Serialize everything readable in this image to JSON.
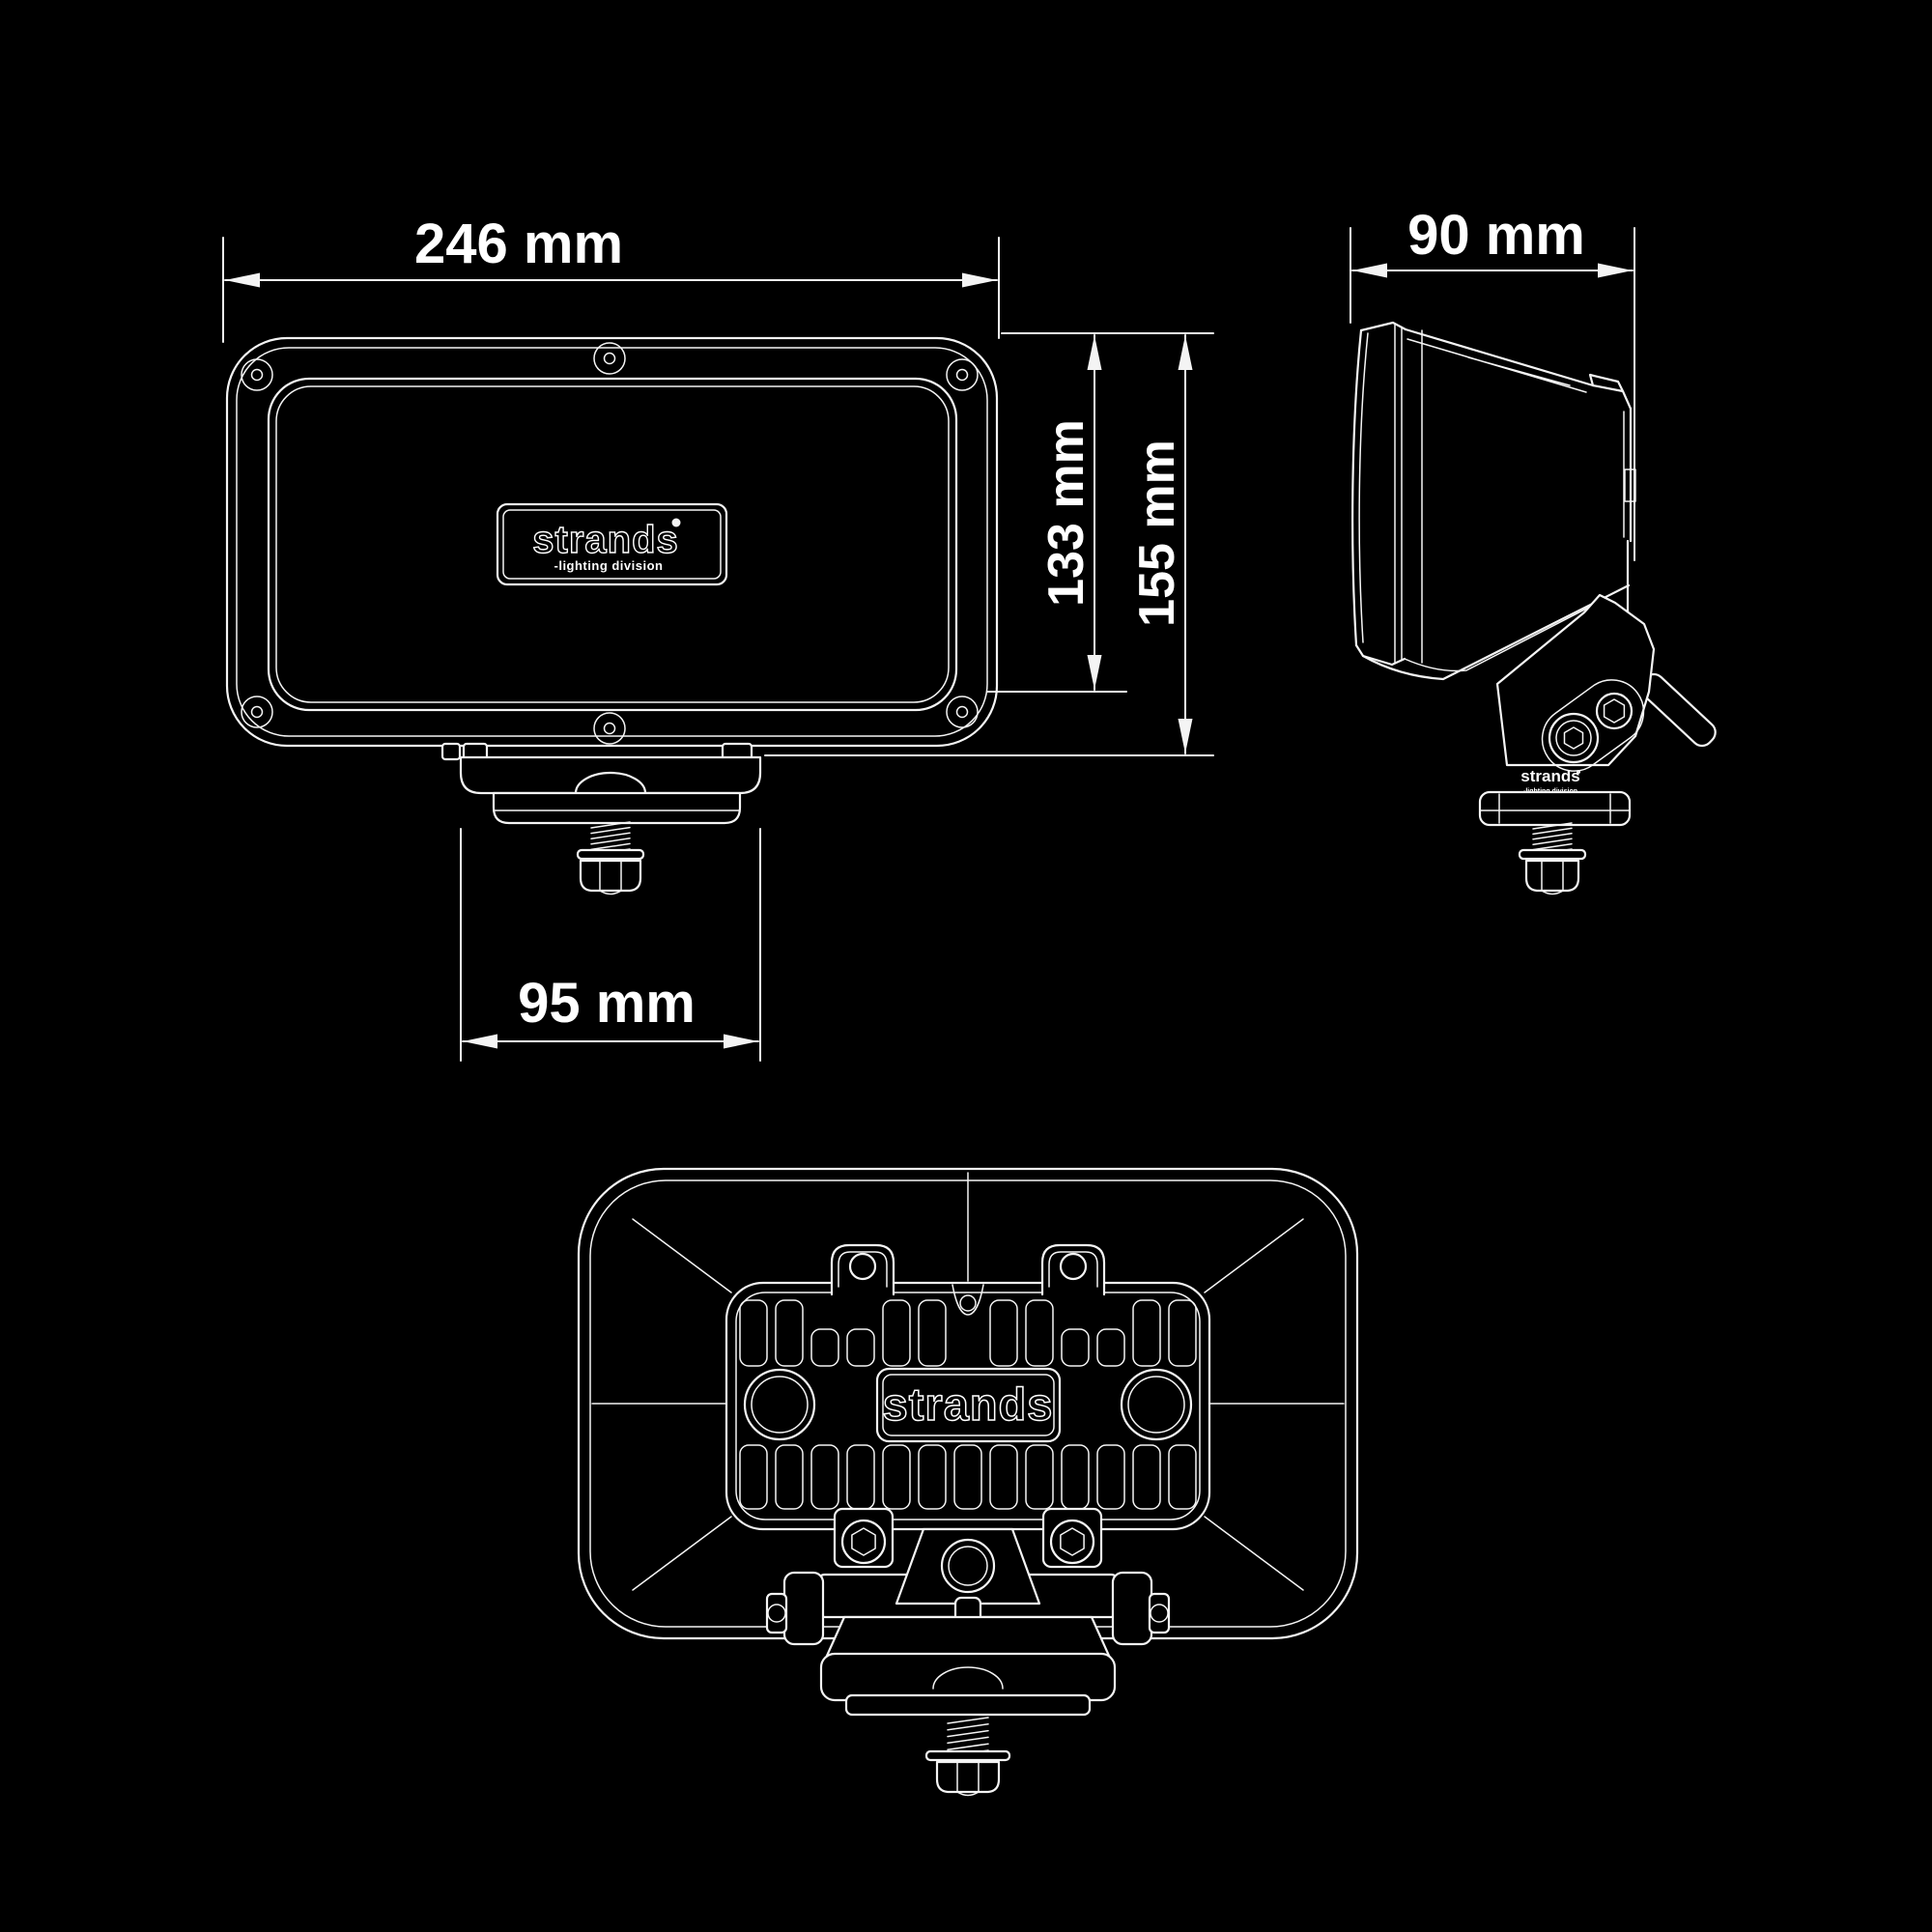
{
  "colors": {
    "background": "#000000",
    "line": "#f4f4f4",
    "text": "#ffffff"
  },
  "brand": {
    "wordmark": "strands",
    "tagline": "-lighting division"
  },
  "dimensions": {
    "front_width": "246 mm",
    "body_height": "133 mm",
    "total_height": "155 mm",
    "bracket_width": "95 mm",
    "side_depth": "90 mm"
  }
}
